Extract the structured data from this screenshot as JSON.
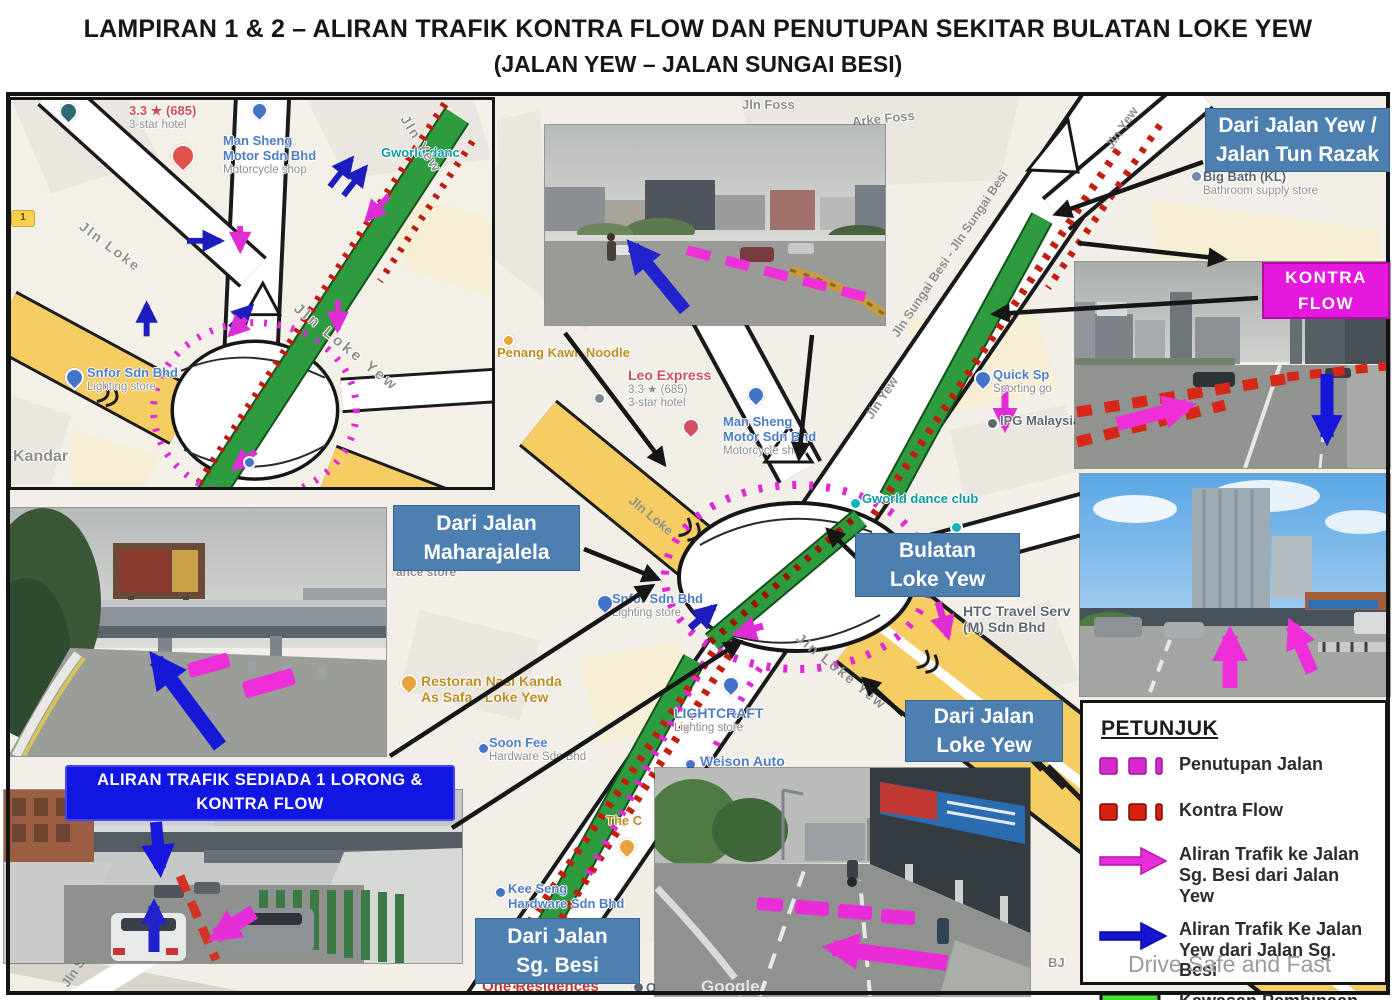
{
  "title": {
    "line1": "LAMPIRAN 1 & 2 – ALIRAN TRAFIK KONTRA FLOW DAN PENUTUPAN SEKITAR BULATAN LOKE YEW",
    "line2": "(JALAN YEW – JALAN SUNGAI BESI)"
  },
  "callouts": {
    "yew_tun_razak": {
      "line1": "Dari Jalan Yew /",
      "line2": "Jalan Tun Razak"
    },
    "kontra_flow": {
      "line1": "KONTRA",
      "line2": "FLOW"
    },
    "maharajalela": {
      "line1": "Dari Jalan",
      "line2": "Maharajalela"
    },
    "bulatan": {
      "line1": "Bulatan",
      "line2": "Loke Yew"
    },
    "loke_yew": {
      "line1": "Dari Jalan",
      "line2": "Loke Yew"
    },
    "sg_besi": {
      "line1": "Dari Jalan",
      "line2": "Sg. Besi"
    },
    "sediada": {
      "line1": "ALIRAN TRAFIK SEDIADA 1 LORONG &",
      "line2": "KONTRA FLOW"
    }
  },
  "legend": {
    "heading": "PETUNJUK",
    "items": [
      {
        "swatch": "magenta-dashes",
        "label": "Penutupan Jalan"
      },
      {
        "swatch": "red-dashes",
        "label": "Kontra Flow"
      },
      {
        "swatch": "magenta-arrow",
        "label": "Aliran Trafik ke Jalan Sg. Besi dari Jalan Yew"
      },
      {
        "swatch": "blue-arrow",
        "label": "Aliran Trafik Ke Jalan Yew dari Jalan Sg. Besi"
      },
      {
        "swatch": "green-box",
        "label": "Kawasan Pembinaan"
      }
    ]
  },
  "map": {
    "streets": {
      "jln_loke": "Jln Loke",
      "jln_yew": "Jln Yew",
      "jln_loke_yew": "Jln Loke Yew",
      "jln_sungai_besi": "Jln Sungai Besi - Jln Sungai Besi",
      "jln_foss": "Jln Foss",
      "arke_foss": "Arke Foss",
      "jln_sunga": "Jln Sunga",
      "bj": "BJ",
      "shield_1": "1"
    },
    "pois": {
      "hotel_rating": "3.3 ★ (685)",
      "hotel_type": "3-star hotel",
      "man_sheng_1": "Man Sheng",
      "man_sheng_2": "Motor Sdn Bhd",
      "man_sheng_3": "Motorcycle shop",
      "gworld": "Gworld dance club",
      "gworld_short": "Gworld danc",
      "snfor_1": "Snfor Sdn Bhd",
      "snfor_2": "Lighting store",
      "kandar": "Kandar",
      "penang": "Penang Kawn Noodle",
      "leo": "Leo Express",
      "htc_1": "HTC Travel Serv",
      "htc_2": "(M) Sdn Bhd",
      "restoran_1": "Restoran Nasi Kanda",
      "restoran_2": "As Safa - Loke Yew",
      "lightcraft_1": "LIGHTCRAFT",
      "lightcraft_2": "Lighting store",
      "weison": "Weison Auto",
      "soon_1": "Soon Fee",
      "soon_2": "Hardware Sdn Bhd",
      "the_c": "The C",
      "kee_1": "Kee Seng",
      "kee_2": "Hardware Sdn Bhd",
      "one_residences": "One Residences",
      "one_res": "One Re",
      "quick_1": "Quick Sp",
      "quick_2": "Sporting go",
      "ipg": "IPG Malaysia",
      "big_bath_1": "Big Bath (KL)",
      "big_bath_2": "Bathroom supply store",
      "ance_store": "ance store"
    }
  },
  "branding": {
    "google": "Google",
    "watermark": "Drive Safe and Fast"
  },
  "colors": {
    "callout_blue": "#4d7fb0",
    "vivid_blue_box": "#1216e3",
    "kontra_magenta_box": "#e519dd",
    "penutupan_magenta": "#e326d8",
    "kontra_red": "#c41e10",
    "aliran_magenta_arrow": "#ee2ed8",
    "aliran_blue_arrow": "#1515cf",
    "kawasan_green": "#3ee32c",
    "road_yellow": "#f6cd63",
    "map_background": "#f2efe8"
  }
}
